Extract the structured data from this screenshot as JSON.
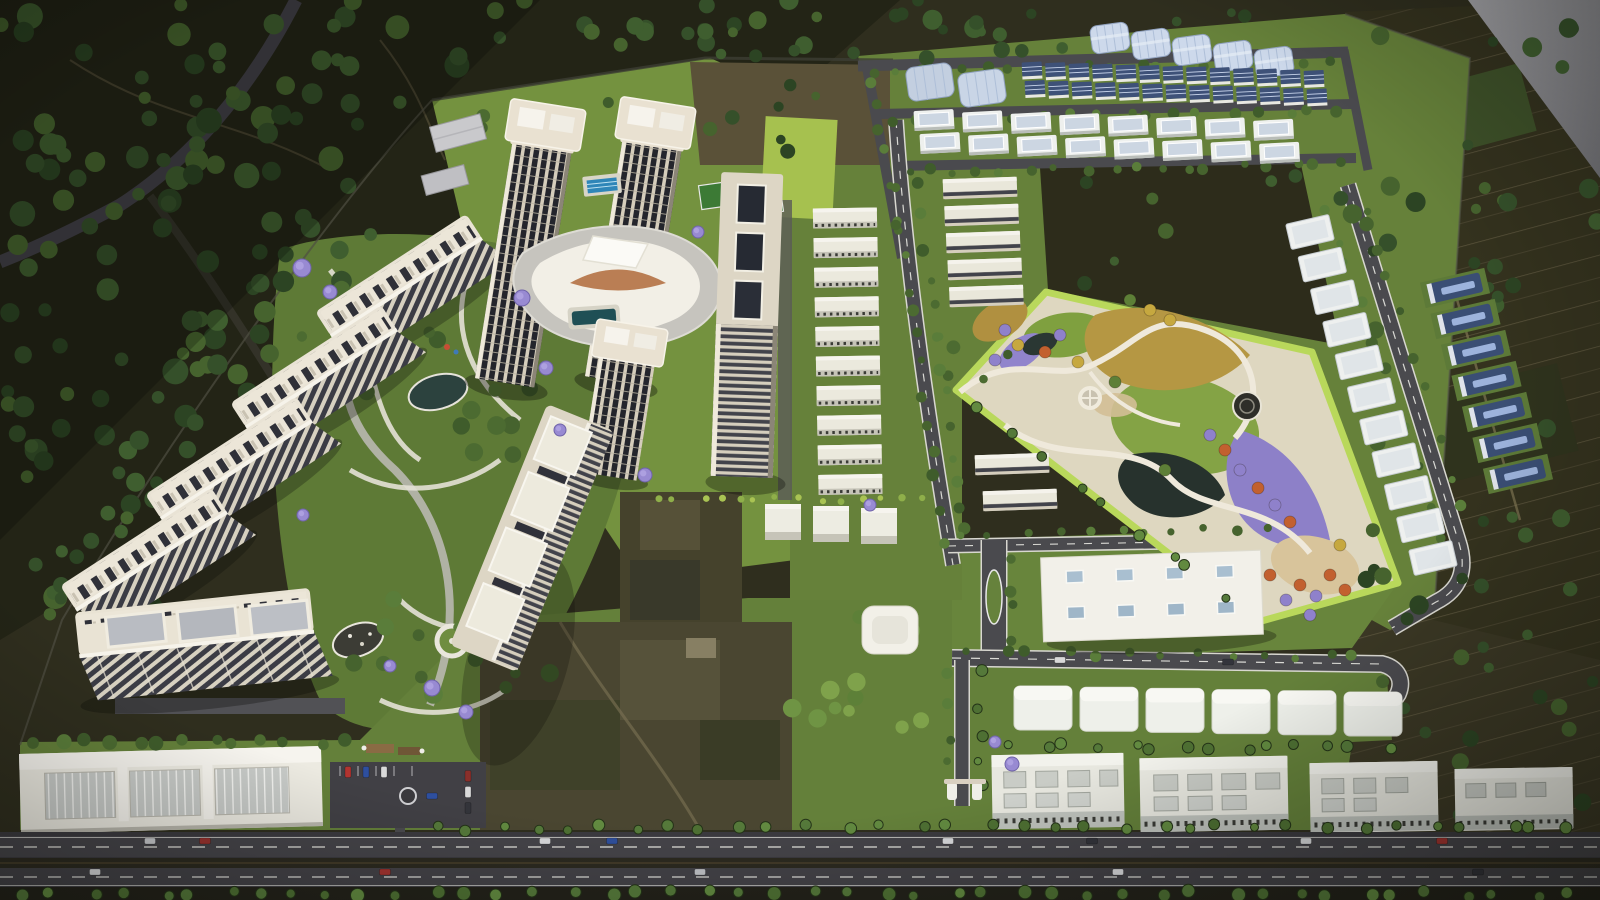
{
  "meta": {
    "description": "Aerial 3D architectural rendering of a township master plan: an arc of cream high-rise apartment slabs and twin towers around a curved white clubhouse with landscaped gardens on the left, grids of blue-roofed row houses, white villas and industrial sheds at the top right, a triangular ornamental park with yellow, purple and orange flower fields at the right, white commercial blocks and a mall at the bottom, all bounded by a tree-lined main road and dark farmland."
  },
  "palette": {
    "terrain_dark": "#2f2e1e",
    "forest_dark": "#232416",
    "farm_dark": "#34321e",
    "site_lawn": "#66813a",
    "lawn_bright": "#74923f",
    "lawn_lime": "#a6c14f",
    "park_rim_lime": "#b9d85b",
    "park_ground": "#ded7c0",
    "flower_yellow": "#b59743",
    "flower_purple": "#8d80c8",
    "flower_orange": "#c2602f",
    "water_dark": "#27322d",
    "sand": "#d8c49b",
    "road_asphalt": "#4a4a4e",
    "road_main": "#3b3a3f",
    "road_line_white": "#d9d9d4",
    "building_cream": "#d9d1c0",
    "building_white": "#f2f0e9",
    "window_dark": "#24252c",
    "roof_gray_panel": "#b9bcc2",
    "shed_blue": "#cdd9eb",
    "rowhouse_roof_blue": "#3e5178",
    "villa_roof": "#ccd6e2",
    "pool_blue": "#2f86b8",
    "amber_louver": "#b06a3a",
    "lavender_tree": "#988ad2",
    "tree_green": "#4c6b31",
    "palm_green": "#55793a",
    "render_edge_gray": "#97979b"
  },
  "scene": {
    "tree_colors": {
      "dark": [
        "#35502a",
        "#2c4423",
        "#3f5e2f",
        "#46632e"
      ],
      "green": [
        "#3f5c2b",
        "#4c6b31",
        "#5a7d3a",
        "#46632e"
      ],
      "bright": [
        "#5d8038",
        "#6f9444",
        "#7fa24b"
      ],
      "palm": [
        "#55793a",
        "#628a40",
        "#4e7033"
      ],
      "hedge": [
        "#8faf4a",
        "#a9c353"
      ]
    },
    "scatters": [
      {
        "target": "scat-outside",
        "rect": [
          0,
          0,
          470,
          190
        ],
        "n": 46,
        "r": [
          6,
          13
        ],
        "c": "dark",
        "seed": 11
      },
      {
        "target": "scat-outside",
        "rect": [
          0,
          140,
          330,
          290
        ],
        "n": 40,
        "r": [
          6,
          13
        ],
        "c": "dark",
        "seed": 12
      },
      {
        "target": "scat-outside",
        "rect": [
          0,
          390,
          210,
          230
        ],
        "n": 22,
        "r": [
          6,
          12
        ],
        "c": "dark",
        "seed": 13
      },
      {
        "target": "scat-outside",
        "rect": [
          470,
          0,
          590,
          58
        ],
        "n": 32,
        "r": [
          5,
          10
        ],
        "c": "dark",
        "seed": 14
      },
      {
        "target": "scat-outside",
        "rect": [
          250,
          212,
          150,
          105
        ],
        "n": 12,
        "r": [
          6,
          11
        ],
        "c": "dark",
        "seed": 15
      },
      {
        "target": "scat-outside",
        "rect": [
          168,
          318,
          145,
          112
        ],
        "n": 12,
        "r": [
          6,
          11
        ],
        "c": "dark",
        "seed": 16
      },
      {
        "target": "scat-outside",
        "rect": [
          96,
          428,
          135,
          112
        ],
        "n": 10,
        "r": [
          6,
          11
        ],
        "c": "dark",
        "seed": 17
      },
      {
        "target": "scat-outside",
        "rect": [
          36,
          538,
          125,
          100
        ],
        "n": 8,
        "r": [
          5,
          10
        ],
        "c": "dark",
        "seed": 18
      },
      {
        "target": "scat-outside",
        "rect": [
          1352,
          28,
          248,
          600
        ],
        "n": 42,
        "r": [
          5,
          10
        ],
        "c": "dark",
        "seed": 19
      },
      {
        "target": "scat-outside",
        "rect": [
          1358,
          618,
          242,
          205
        ],
        "n": 16,
        "r": [
          5,
          9
        ],
        "c": "dark",
        "seed": 20
      },
      {
        "target": "scat-outside",
        "rect": [
          690,
          62,
          205,
          100
        ],
        "n": 7,
        "r": [
          4,
          8
        ],
        "c": "dark",
        "seed": 21
      },
      {
        "target": "scat-outside",
        "rect": [
          900,
          12,
          445,
          40
        ],
        "n": 9,
        "r": [
          4,
          8
        ],
        "c": "dark",
        "seed": 22
      },
      {
        "target": "scat-outside",
        "rect": [
          1060,
          175,
          285,
          110
        ],
        "n": 8,
        "r": [
          4,
          8
        ],
        "c": "dark",
        "seed": 23
      },
      {
        "target": "scat-site",
        "rect": [
          300,
          252,
          240,
          208
        ],
        "n": 17,
        "r": [
          5,
          10
        ],
        "c": "green",
        "seed": 31
      },
      {
        "target": "scat-site",
        "rect": [
          338,
          558,
          215,
          150
        ],
        "n": 13,
        "r": [
          5,
          10
        ],
        "c": "green",
        "seed": 32
      },
      {
        "target": "scat-site",
        "rect": [
          748,
          600,
          195,
          132
        ],
        "n": 12,
        "r": [
          5,
          10
        ],
        "c": "bright",
        "seed": 33
      },
      {
        "target": "scat-site",
        "rect": [
          938,
          328,
          75,
          62
        ],
        "n": 5,
        "r": [
          4,
          7
        ],
        "c": "green",
        "seed": 34
      },
      {
        "target": "scat-site",
        "rect": [
          480,
          100,
          220,
          55
        ],
        "n": 7,
        "r": [
          4,
          7
        ],
        "c": "green",
        "seed": 35
      },
      {
        "target": "scat-road",
        "line": [
          860,
          73,
          1346,
          60
        ],
        "n": 20,
        "r": [
          3.5,
          6
        ],
        "c": "green",
        "seed": 41
      },
      {
        "target": "scat-road",
        "line": [
          882,
          120,
          1352,
          110
        ],
        "n": 18,
        "r": [
          3.5,
          6
        ],
        "c": "green",
        "seed": 42
      },
      {
        "target": "scat-road",
        "line": [
          894,
          172,
          1356,
          164
        ],
        "n": 18,
        "r": [
          3.5,
          6
        ],
        "c": "green",
        "seed": 43
      },
      {
        "target": "scat-road",
        "line": [
          870,
          70,
          904,
          252
        ],
        "n": 7,
        "r": [
          3.5,
          6
        ],
        "c": "green",
        "seed": 44
      },
      {
        "target": "scat-road",
        "line": [
          893,
          185,
          948,
          560
        ],
        "n": 13,
        "r": [
          3.5,
          6.5
        ],
        "c": "green",
        "seed": 45
      },
      {
        "target": "scat-road",
        "line": [
          915,
          182,
          968,
          556
        ],
        "n": 13,
        "r": [
          3.5,
          6.5
        ],
        "c": "green",
        "seed": 46
      },
      {
        "target": "scat-road",
        "line": [
          1322,
          196,
          1448,
          550
        ],
        "n": 11,
        "r": [
          3.5,
          6.5
        ],
        "c": "green",
        "seed": 47
      },
      {
        "target": "scat-road",
        "line": [
          1360,
          190,
          1472,
          540
        ],
        "n": 9,
        "r": [
          3.5,
          6
        ],
        "c": "green",
        "seed": 48
      },
      {
        "target": "scat-road",
        "line": [
          952,
          534,
          1288,
          528
        ],
        "n": 11,
        "r": [
          3.5,
          6
        ],
        "c": "green",
        "seed": 49
      },
      {
        "target": "scat-road",
        "line": [
          956,
          652,
          1378,
          657
        ],
        "n": 13,
        "r": [
          3.5,
          6
        ],
        "c": "green",
        "seed": 50
      },
      {
        "target": "scat-road",
        "line": [
          10,
          862,
          1594,
          863
        ],
        "n": 52,
        "r": [
          3.5,
          6
        ],
        "c": "green",
        "seed": 51
      },
      {
        "target": "scat-road",
        "line": [
          950,
          670,
          950,
          798
        ],
        "n": 5,
        "r": [
          3.5,
          6
        ],
        "c": "green",
        "seed": 52
      },
      {
        "target": "scat-road",
        "line": [
          980,
          672,
          980,
          800
        ],
        "n": 5,
        "r": [
          3.5,
          6
        ],
        "c": "palm",
        "seed": 53
      },
      {
        "target": "scat-road",
        "line": [
          1010,
          556,
          1010,
          648
        ],
        "n": 4,
        "r": [
          3.5,
          6
        ],
        "c": "green",
        "seed": 54
      },
      {
        "target": "scat-palm",
        "line": [
          8,
          893,
          1594,
          894
        ],
        "n": 46,
        "r": [
          4.5,
          7
        ],
        "c": "palm",
        "seed": 61
      },
      {
        "target": "scat-palm",
        "line": [
          422,
          828,
          1594,
          826
        ],
        "n": 34,
        "r": [
          4,
          6
        ],
        "c": "palm",
        "seed": 62
      },
      {
        "target": "scat-palm",
        "line": [
          1006,
          746,
          1402,
          748
        ],
        "n": 14,
        "r": [
          4,
          6
        ],
        "c": "palm",
        "seed": 63
      },
      {
        "target": "scat-palm",
        "line": [
          18,
          742,
          358,
          742
        ],
        "n": 13,
        "r": [
          5,
          8
        ],
        "c": "green",
        "seed": 64
      },
      {
        "target": "scat-palm",
        "line": [
          975,
          405,
          1245,
          612
        ],
        "n": 9,
        "r": [
          4,
          6
        ],
        "c": "palm",
        "seed": 65
      },
      {
        "target": "scat-hedge",
        "line": [
          650,
          498,
          940,
          500
        ],
        "n": 14,
        "r": [
          2.5,
          4
        ],
        "c": "hedge",
        "seed": 71
      }
    ],
    "rows": [
      {
        "target": "g-arc",
        "shape": "arcslab",
        "x": 407,
        "y": 288,
        "dx": -85,
        "dy": 91.3,
        "n": 4
      },
      {
        "target": "g-towers",
        "shape": "tower",
        "x": 545,
        "y": 128,
        "dx": 110,
        "dy": -2,
        "n": 2
      },
      {
        "target": "g-midcol",
        "shape": "midslab",
        "x": 845,
        "y": 218,
        "dx": 0.6,
        "dy": 29.6,
        "n": 10
      },
      {
        "target": "g-eastrow",
        "shape": "eastslab",
        "x": 980,
        "y": 188,
        "dx": 1.6,
        "dy": 27,
        "n": 5
      },
      {
        "target": "g-eastrow",
        "shape": "eastslab",
        "x": 1012,
        "y": 464,
        "dx": 8,
        "dy": 36,
        "n": 2
      },
      {
        "target": "g-sheds",
        "shape": "shed",
        "x": 1110,
        "y": 38,
        "dx": 41,
        "dy": 6,
        "n": 5
      },
      {
        "target": "g-rowhouses",
        "shape": "rowhouse",
        "x": 1032,
        "y": 70,
        "dx": 23.5,
        "dy": 0.7,
        "n": 13
      },
      {
        "target": "g-rowhouses",
        "shape": "rowhouse",
        "x": 1035,
        "y": 88.5,
        "dx": 23.5,
        "dy": 0.7,
        "n": 13
      },
      {
        "target": "g-villas",
        "shape": "villa",
        "x": 934,
        "y": 120,
        "dx": 48.5,
        "dy": 1.4,
        "n": 8
      },
      {
        "target": "g-villas",
        "shape": "villa",
        "x": 940,
        "y": 143,
        "dx": 48.5,
        "dy": 1.4,
        "n": 8
      },
      {
        "target": "g-plots",
        "shape": "plot",
        "x": 1310,
        "y": 232,
        "dx": 12.3,
        "dy": 32.6,
        "n": 11
      },
      {
        "target": "g-bluewh",
        "shape": "bluewh",
        "x": 1455,
        "y": 288,
        "dx": 10.5,
        "dy": 31,
        "n": 7
      },
      {
        "target": "g-commrow",
        "shape": "commbox",
        "x": 1043,
        "y": 708,
        "dx": 66,
        "dy": 1.2,
        "n": 6
      },
      {
        "target": "g-3box",
        "shape": "box3",
        "x": 783,
        "y": 522,
        "dx": 48,
        "dy": 2,
        "n": 3
      }
    ],
    "cars": [
      [
        150,
        841,
        "#c7c9cc",
        0
      ],
      [
        205,
        841,
        "#98322e",
        0
      ],
      [
        545,
        841,
        "#d8d9db",
        0
      ],
      [
        612,
        841,
        "#2f4f9b",
        0
      ],
      [
        948,
        841,
        "#d8d9db",
        0
      ],
      [
        1092,
        841,
        "#33343b",
        0
      ],
      [
        1306,
        841,
        "#d8d9db",
        0
      ],
      [
        1442,
        841,
        "#a33430",
        0
      ],
      [
        95,
        872,
        "#d8d9db",
        0
      ],
      [
        385,
        872,
        "#a33430",
        0
      ],
      [
        700,
        872,
        "#c0c2c6",
        0
      ],
      [
        1118,
        872,
        "#d8d9db",
        0
      ],
      [
        1478,
        872,
        "#33343b",
        0
      ],
      [
        348,
        772,
        "#b23430",
        1
      ],
      [
        366,
        772,
        "#2e4f9e",
        1
      ],
      [
        384,
        772,
        "#d9d9d9",
        1
      ],
      [
        468,
        776,
        "#8a2f2a",
        1
      ],
      [
        468,
        792,
        "#d9d9d9",
        1
      ],
      [
        468,
        808,
        "#33343a",
        1
      ],
      [
        432,
        796,
        "#2e4f9e",
        0
      ],
      [
        1060,
        660,
        "#d9d9d9",
        0
      ],
      [
        1228,
        662,
        "#33343b",
        0
      ]
    ],
    "park_tree_colors": {
      "o": "#c2602f",
      "p": "#8f81cb",
      "y": "#c6a83f",
      "g": "#5d7f37"
    },
    "park_trees": [
      [
        1300,
        585,
        "o"
      ],
      [
        1316,
        596,
        "p"
      ],
      [
        1286,
        600,
        "p"
      ],
      [
        1330,
        575,
        "o"
      ],
      [
        1345,
        590,
        "o"
      ],
      [
        1310,
        615,
        "p"
      ],
      [
        1270,
        575,
        "o"
      ],
      [
        1255,
        595,
        "p"
      ],
      [
        1340,
        545,
        "y"
      ],
      [
        1240,
        470,
        "p"
      ],
      [
        1258,
        488,
        "o"
      ],
      [
        1275,
        505,
        "p"
      ],
      [
        1290,
        522,
        "o"
      ],
      [
        1225,
        450,
        "o"
      ],
      [
        1210,
        435,
        "p"
      ],
      [
        1060,
        335,
        "p"
      ],
      [
        1045,
        352,
        "o"
      ],
      [
        1078,
        362,
        "y"
      ],
      [
        1005,
        330,
        "p"
      ],
      [
        1018,
        345,
        "y"
      ],
      [
        995,
        360,
        "p"
      ],
      [
        1150,
        310,
        "y"
      ],
      [
        1170,
        320,
        "y"
      ],
      [
        1130,
        300,
        "g"
      ],
      [
        1115,
        382,
        "g"
      ],
      [
        1165,
        470,
        "g"
      ]
    ],
    "lavender_color": "#988ad2",
    "lavender": [
      [
        302,
        268,
        9
      ],
      [
        330,
        292,
        7
      ],
      [
        522,
        298,
        8
      ],
      [
        546,
        368,
        7
      ],
      [
        560,
        430,
        6
      ],
      [
        432,
        688,
        8
      ],
      [
        466,
        712,
        7
      ],
      [
        390,
        666,
        6
      ],
      [
        1012,
        764,
        7
      ],
      [
        995,
        742,
        6
      ],
      [
        698,
        232,
        6
      ],
      [
        870,
        505,
        6
      ],
      [
        645,
        475,
        7
      ],
      [
        303,
        515,
        6
      ]
    ]
  }
}
